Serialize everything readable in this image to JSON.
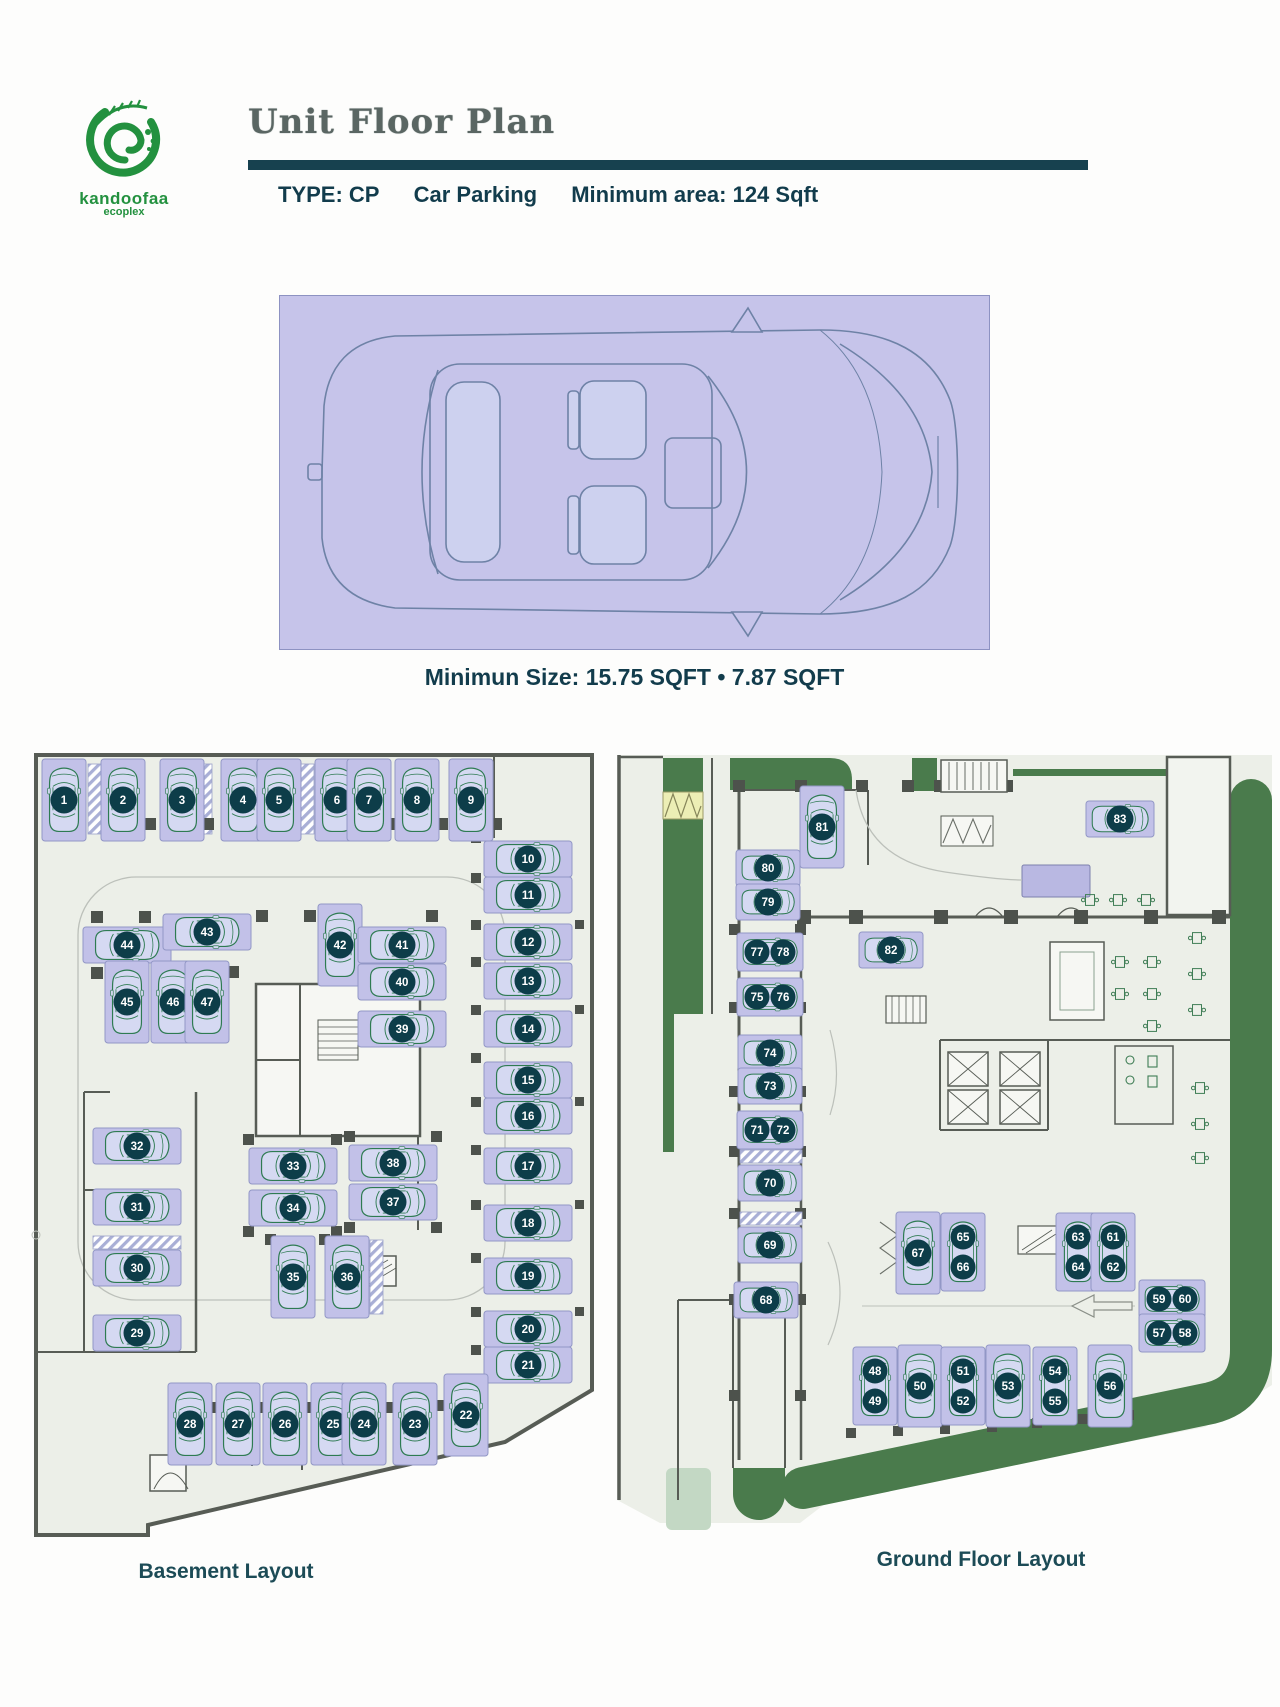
{
  "header": {
    "logo_line1": "kandoofaa",
    "logo_line2": "ecoplex",
    "title": "Unit Floor Plan",
    "subtitle_type_label": "TYPE: CP",
    "subtitle_type_name": "Car Parking",
    "subtitle_min_area": "Minimum area: 124 Sqft"
  },
  "unit_diagram": {
    "caption": "Minimun Size: 15.75 SQFT • 7.87 SQFT"
  },
  "plans": {
    "basement": {
      "label": "Basement Layout",
      "spots": [
        {
          "n": "1",
          "x": 64,
          "y": 800,
          "o": "v"
        },
        {
          "n": "2",
          "x": 123,
          "y": 800,
          "o": "v"
        },
        {
          "n": "3",
          "x": 182,
          "y": 800,
          "o": "v"
        },
        {
          "n": "4",
          "x": 243,
          "y": 800,
          "o": "v"
        },
        {
          "n": "5",
          "x": 279,
          "y": 800,
          "o": "v"
        },
        {
          "n": "6",
          "x": 337,
          "y": 800,
          "o": "v"
        },
        {
          "n": "7",
          "x": 369,
          "y": 800,
          "o": "v"
        },
        {
          "n": "8",
          "x": 417,
          "y": 800,
          "o": "v"
        },
        {
          "n": "9",
          "x": 471,
          "y": 800,
          "o": "v"
        },
        {
          "n": "10",
          "x": 528,
          "y": 859,
          "o": "h"
        },
        {
          "n": "11",
          "x": 528,
          "y": 895,
          "o": "h"
        },
        {
          "n": "12",
          "x": 528,
          "y": 942,
          "o": "h"
        },
        {
          "n": "13",
          "x": 528,
          "y": 981,
          "o": "h"
        },
        {
          "n": "14",
          "x": 528,
          "y": 1029,
          "o": "h"
        },
        {
          "n": "15",
          "x": 528,
          "y": 1080,
          "o": "h"
        },
        {
          "n": "16",
          "x": 528,
          "y": 1116,
          "o": "h"
        },
        {
          "n": "17",
          "x": 528,
          "y": 1166,
          "o": "h"
        },
        {
          "n": "18",
          "x": 528,
          "y": 1223,
          "o": "h"
        },
        {
          "n": "19",
          "x": 528,
          "y": 1276,
          "o": "h"
        },
        {
          "n": "20",
          "x": 528,
          "y": 1329,
          "o": "h"
        },
        {
          "n": "21",
          "x": 528,
          "y": 1365,
          "o": "h"
        },
        {
          "n": "44",
          "x": 127,
          "y": 945,
          "o": "h"
        },
        {
          "n": "43",
          "x": 207,
          "y": 932,
          "o": "h"
        },
        {
          "n": "42",
          "x": 340,
          "y": 945,
          "o": "v"
        },
        {
          "n": "41",
          "x": 402,
          "y": 945,
          "o": "h"
        },
        {
          "n": "40",
          "x": 402,
          "y": 982,
          "o": "h"
        },
        {
          "n": "39",
          "x": 402,
          "y": 1029,
          "o": "h"
        },
        {
          "n": "45",
          "x": 127,
          "y": 1002,
          "o": "v"
        },
        {
          "n": "46",
          "x": 173,
          "y": 1002,
          "o": "v"
        },
        {
          "n": "47",
          "x": 207,
          "y": 1002,
          "o": "v"
        },
        {
          "n": "32",
          "x": 137,
          "y": 1146,
          "o": "h"
        },
        {
          "n": "31",
          "x": 137,
          "y": 1207,
          "o": "h"
        },
        {
          "n": "30",
          "x": 137,
          "y": 1268,
          "o": "h"
        },
        {
          "n": "29",
          "x": 137,
          "y": 1333,
          "o": "h"
        },
        {
          "n": "33",
          "x": 293,
          "y": 1166,
          "o": "h"
        },
        {
          "n": "34",
          "x": 293,
          "y": 1208,
          "o": "h"
        },
        {
          "n": "38",
          "x": 393,
          "y": 1163,
          "o": "h"
        },
        {
          "n": "37",
          "x": 393,
          "y": 1202,
          "o": "h"
        },
        {
          "n": "35",
          "x": 293,
          "y": 1277,
          "o": "v"
        },
        {
          "n": "36",
          "x": 347,
          "y": 1277,
          "o": "v"
        },
        {
          "n": "28",
          "x": 190,
          "y": 1424,
          "o": "v"
        },
        {
          "n": "27",
          "x": 238,
          "y": 1424,
          "o": "v"
        },
        {
          "n": "26",
          "x": 285,
          "y": 1424,
          "o": "v"
        },
        {
          "n": "25",
          "x": 333,
          "y": 1424,
          "o": "v"
        },
        {
          "n": "24",
          "x": 364,
          "y": 1424,
          "o": "v"
        },
        {
          "n": "23",
          "x": 415,
          "y": 1424,
          "o": "v"
        },
        {
          "n": "22",
          "x": 466,
          "y": 1415,
          "o": "v"
        }
      ]
    },
    "ground": {
      "label": "Ground Floor Layout",
      "spots": [
        {
          "n": "81",
          "x": 822,
          "y": 827,
          "o": "v"
        },
        {
          "n": "80",
          "x": 768,
          "y": 868,
          "o": "h",
          "w": 64
        },
        {
          "n": "79",
          "x": 768,
          "y": 902,
          "o": "h",
          "w": 64
        },
        {
          "badges": [
            "77",
            "78"
          ],
          "x": 770,
          "y": 952,
          "o": "h2"
        },
        {
          "badges": [
            "75",
            "76"
          ],
          "x": 770,
          "y": 997,
          "o": "h2"
        },
        {
          "n": "74",
          "x": 770,
          "y": 1053,
          "o": "h",
          "w": 64
        },
        {
          "n": "73",
          "x": 770,
          "y": 1086,
          "o": "h",
          "w": 64
        },
        {
          "badges": [
            "71",
            "72"
          ],
          "x": 770,
          "y": 1130,
          "o": "h2"
        },
        {
          "n": "70",
          "x": 770,
          "y": 1183,
          "o": "h",
          "w": 64
        },
        {
          "n": "69",
          "x": 770,
          "y": 1245,
          "o": "h",
          "w": 64
        },
        {
          "n": "68",
          "x": 766,
          "y": 1300,
          "o": "h",
          "w": 64
        },
        {
          "n": "82",
          "x": 891,
          "y": 950,
          "o": "h",
          "w": 64
        },
        {
          "n": "83",
          "x": 1120,
          "y": 819,
          "o": "h",
          "w": 68
        },
        {
          "n": "67",
          "x": 918,
          "y": 1253,
          "o": "v"
        },
        {
          "badges": [
            "65",
            "66"
          ],
          "x": 963,
          "y": 1252,
          "o": "v2"
        },
        {
          "badges": [
            "63",
            "64"
          ],
          "x": 1078,
          "y": 1252,
          "o": "v2"
        },
        {
          "badges": [
            "61",
            "62"
          ],
          "x": 1113,
          "y": 1252,
          "o": "v2"
        },
        {
          "badges": [
            "59",
            "60"
          ],
          "x": 1172,
          "y": 1299,
          "o": "h2"
        },
        {
          "badges": [
            "57",
            "58"
          ],
          "x": 1172,
          "y": 1333,
          "o": "h2"
        },
        {
          "badges": [
            "48",
            "49"
          ],
          "x": 875,
          "y": 1386,
          "o": "v2"
        },
        {
          "n": "50",
          "x": 920,
          "y": 1386,
          "o": "v"
        },
        {
          "badges": [
            "51",
            "52"
          ],
          "x": 963,
          "y": 1386,
          "o": "v2"
        },
        {
          "n": "53",
          "x": 1008,
          "y": 1386,
          "o": "v"
        },
        {
          "badges": [
            "54",
            "55"
          ],
          "x": 1055,
          "y": 1386,
          "o": "v2"
        },
        {
          "n": "56",
          "x": 1110,
          "y": 1386,
          "o": "v"
        }
      ]
    }
  },
  "colors": {
    "accent_teal": "#17414f",
    "text_teal": "#123c4c",
    "logo_green": "#23913f",
    "panel_lavender": "#c6c4ea",
    "spot_lavender": "#c2c1e8",
    "badge_dark": "#0d3d49",
    "car_outline_green": "#2e7b52",
    "floor": "#ecefe8",
    "wall_gray": "#575c55",
    "landscape_green": "#4a7b4c",
    "landscape_light": "#c3d8c4",
    "ramp_yellow": "#eceeb5"
  }
}
